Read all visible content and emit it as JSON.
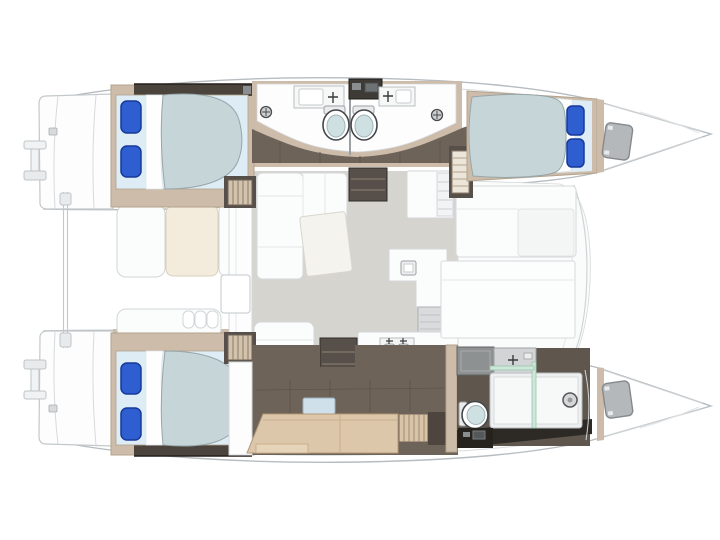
{
  "diagram": {
    "kind": "catamaran-interior-floor-plan",
    "orientation": "bows-pointing-right",
    "hulls": [
      {
        "name": "upper-hull",
        "areas": [
          "swim-platform",
          "aft-double-cabin",
          "aft-head-with-toilet-sink-shower",
          "forward-head-with-toilet-sink-shower",
          "companionway-steps",
          "forward-double-cabin",
          "bow-hatch"
        ]
      },
      {
        "name": "lower-hull",
        "areas": [
          "swim-platform",
          "aft-double-cabin",
          "desk-settee-lounge",
          "slatted-wardrobe",
          "forward-bathroom-with-shower-toilet-vanity",
          "bow-hatch"
        ]
      }
    ],
    "bridgedeck": {
      "areas": [
        "aft-cockpit-with-seats-and-table",
        "saloon-l-shaped-sofa",
        "rotated-coffee-table",
        "companionway-shelf",
        "galley-island-with-sink",
        "appliance-unit",
        "aft-galley-counter-with-double-sink",
        "dining-settee",
        "dining-table"
      ]
    },
    "fixture_inventory": {
      "double_beds": 3,
      "blue_pillows_per_bed": 2,
      "toilets": 3,
      "head_sinks": 3,
      "galley_sinks": 1,
      "showers": 3,
      "stern_davits": 2
    }
  },
  "colors": {
    "background": "#ffffff",
    "hull_outline": "#b6bcc0",
    "deck_trim_beige": "#cdbca9",
    "walkway_floor_taupe": "#6e6359",
    "dark_step_wood": "#57504a",
    "wardrobe_dark": "#4a443d",
    "saloon_floor_gray": "#d6d4cf",
    "furniture_white": "#fbfcfc",
    "duvet_blue_gray": "#c6d5d8",
    "sheet_pale_blue": "#ddecf5",
    "pillow_blue": "#2e5ecf",
    "pillow_border": "#16399b",
    "toilet_lid_aqua": "#cfe0e3",
    "shower_glass_green": "#cde8d9",
    "desk_wood": "#dcc7ab",
    "cockpit_cushion_cream": "#f3ecdc",
    "appliance_gray": "#d9dbdc",
    "bathroom_dark_floor": "#2d2a26",
    "bow_window_gray": "#b4b8bb"
  }
}
